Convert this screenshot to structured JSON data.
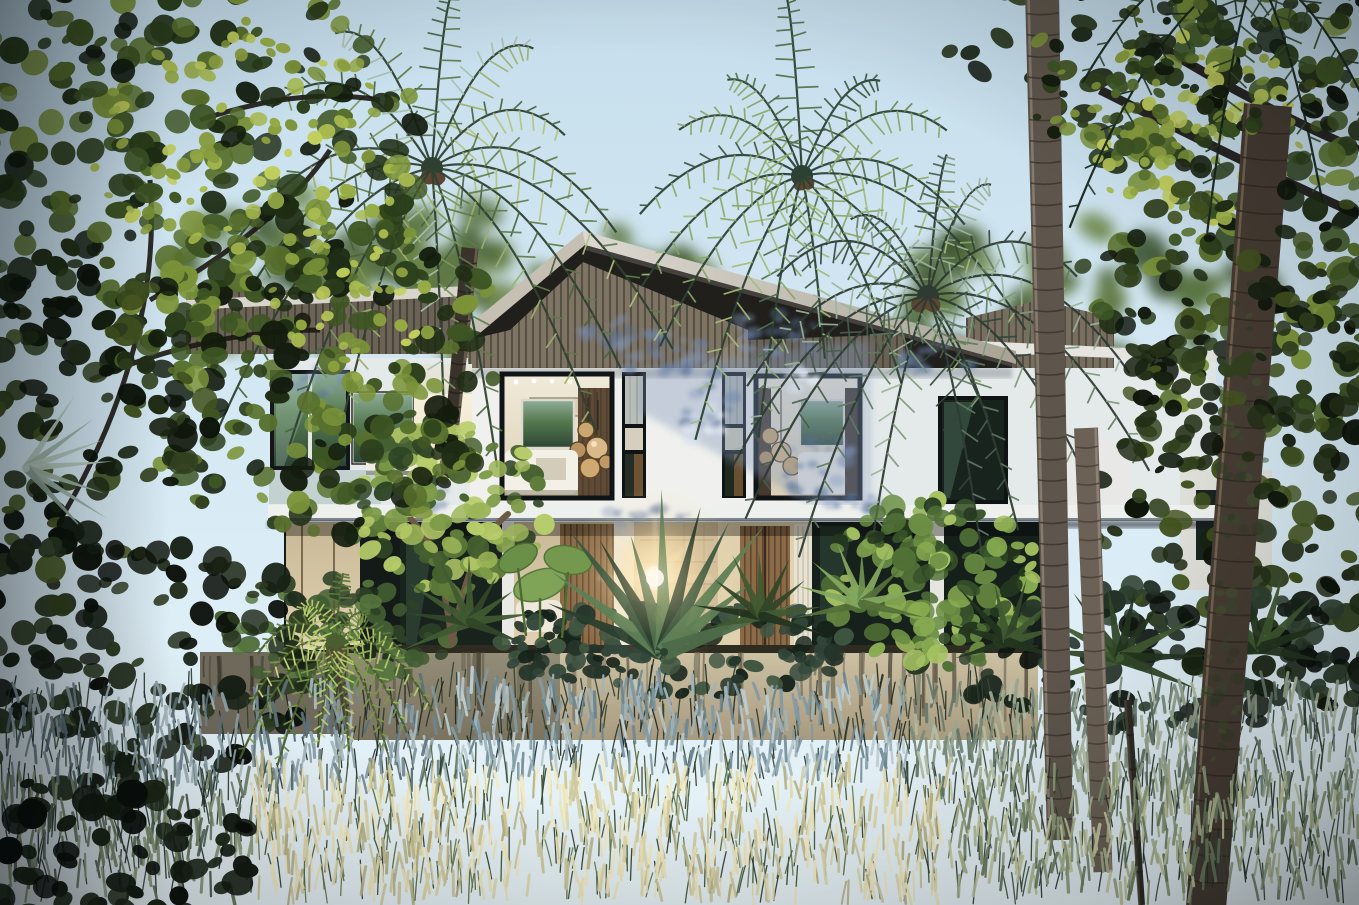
{
  "scene": {
    "description": "Dusk photorealistic rendering of a modern two-storey tropical villa with a wood-slat gable roof, glowing bedroom windows and open ground-floor bays, hidden behind palm trees, jungle foliage, palm trunks and a meadow of backlit feather grass",
    "colors": {
      "sky_top": "#c6deec",
      "sky_mid": "#d8ebf5",
      "sky_low": "#e9f4f8",
      "wall": "#f0f1ee",
      "wall_cool": "#e4e9ea",
      "roof_dark": "#201f1b",
      "slat_lit": "#8f8472",
      "slat_line": "#635b4d",
      "slat_mid": "#776e5f",
      "slat_dark": "#6b6355",
      "fascia": "#c9c3b7",
      "fascia_bright": "#dcd9d1",
      "frame": "#14171a",
      "glass_dark": "#18231e",
      "glass_green": "#3a5242",
      "interior_warm": "#e4d7ba",
      "interior_wood": "#8a6a47",
      "wood_dark": "#46382c",
      "concrete": "#cfc3a6",
      "concrete_shadow": "#9a8f76",
      "slab": "#eef0ee",
      "stone_wall": "#cbb896",
      "curtain": "#e8e2d2",
      "flare_core": "#fff8e4",
      "flare_glow": "#ffe3a6",
      "bed_white": "#f3f0e8",
      "pendant_brass": "#c9a76f"
    },
    "palettes": {
      "bgGreen": [
        "#3c5330",
        "#4c6438",
        "#5d7642",
        "#6d854b"
      ],
      "treeDark": [
        "#131c0e",
        "#1f2d15",
        "#2b3e1b",
        "#3e5523",
        "#58702d",
        "#7b9339"
      ],
      "treeDeep": [
        "#0e150b",
        "#182212",
        "#232f17",
        "#31411e",
        "#42531f"
      ],
      "treeLit": [
        "#8ba03f",
        "#a9bc50",
        "#c2cf5e",
        "#97ab46"
      ],
      "frangipani": [
        "#2e4424",
        "#46602f",
        "#5f7c3a",
        "#7d9a48",
        "#9cb558",
        "#b7cc6a"
      ],
      "bushLit": [
        "#24371f",
        "#38522a",
        "#507036",
        "#6c8f44",
        "#8aad52",
        "#a6c263"
      ],
      "planterDark": [
        "#16231a",
        "#24352a",
        "#32473a",
        "#405641"
      ],
      "planterMid": [
        "#1d2c1c",
        "#2e4227",
        "#415c32",
        "#57763e"
      ],
      "shrubDark": [
        "#0c110c",
        "#161f13",
        "#202b19",
        "#2c3a21"
      ],
      "shrubDeep": [
        "#090e0a",
        "#121a10",
        "#1b2516"
      ],
      "groundCover": [
        "#0d130e",
        "#18231a",
        "#243227",
        "#2f4030"
      ],
      "palmA": [
        "#49633f",
        "#5f7b4a",
        "#7b955c",
        "#9db06e",
        "#b4c27e",
        "#a8bfae"
      ],
      "palmB": [
        "#3d5540",
        "#527049",
        "#6b8a55",
        "#8aa768",
        "#a3bb7a"
      ],
      "palmC": [
        "#36463c",
        "#495d4e",
        "#617a62",
        "#7e9a7c",
        "#9db39a"
      ],
      "palmDark": [
        "#1c2b1e",
        "#283c2a",
        "#354c34",
        "#44603f"
      ],
      "litPalm": [
        "#7d9a4a",
        "#9cb85c",
        "#bccf70",
        "#d6e088",
        "#5d7a3c"
      ],
      "travPalm": [
        "#2b3f2e",
        "#3d5840",
        "#4e6c4a",
        "#5f7f55"
      ],
      "fanDark": [
        "#23351f",
        "#314728",
        "#405a31"
      ],
      "fanLit": [
        "#55703a",
        "#6d8f4f",
        "#84a85e"
      ],
      "silver": [
        "#9fb5a8",
        "#b5c8bc",
        "#8aa095"
      ],
      "moss": [
        "#2f3a26",
        "#3a4a2e",
        "#44552f"
      ],
      "shadowBlue": [
        "rgba(110,134,173,0.5)",
        "rgba(88,112,152,0.45)",
        "rgba(130,152,190,0.4)"
      ],
      "lightDapple": [
        "rgba(235,241,250,0.55)",
        "rgba(214,226,242,0.5)"
      ],
      "tipsShadowL": [
        "#5c7078",
        "#72868f",
        "#8da0a8",
        "#a6b8bc"
      ],
      "tipsShadow": [
        "#8199a2",
        "#9fb3b9",
        "#bccbcd",
        "#6b8590"
      ],
      "tipsSage": [
        "#7c8b7a",
        "#98a691",
        "#b2bda4",
        "#65776a"
      ],
      "tipsDim": [
        "#4e5f52",
        "#66755f",
        "#808e70",
        "#939f7e"
      ],
      "tipsWarm": [
        "#cfc9a0",
        "#e0d9ac",
        "#eee6bc",
        "#b9b488",
        "#f4ecc8"
      ],
      "tipsMixed": [
        "#8e9c7c",
        "#aab58e",
        "#c5c9a0",
        "#6b7c60"
      ],
      "stemsDark": [
        "#1a2620",
        "#27352c",
        "#31402f"
      ],
      "stemsDark2": [
        "#232f27",
        "#31402f",
        "#3c4c38"
      ],
      "stemsWarm": [
        "#3c4e2e",
        "#55683a",
        "#2c3a24",
        "#68794a"
      ]
    },
    "clusters": [
      {
        "t": "bg-trees",
        "cx": 520,
        "cy": 295,
        "rx": 210,
        "ry": 95,
        "n": 45,
        "r0": 10,
        "r1": 26,
        "pal": "bgGreen"
      },
      {
        "t": "bg-trees",
        "cx": 1075,
        "cy": 300,
        "rx": 190,
        "ry": 85,
        "n": 40,
        "r0": 10,
        "r1": 24,
        "pal": "bgGreen"
      },
      {
        "t": "bg-trees",
        "cx": 300,
        "cy": 270,
        "rx": 170,
        "ry": 75,
        "n": 30,
        "r0": 10,
        "r1": 22,
        "pal": "bgGreen"
      },
      {
        "t": "planter-bushes",
        "cx": 933,
        "cy": 583,
        "rx": 108,
        "ry": 86,
        "n": 140,
        "r0": 5,
        "r1": 13,
        "pal": "bushLit"
      },
      {
        "t": "planter-bushes",
        "cx": 700,
        "cy": 648,
        "rx": 150,
        "ry": 48,
        "n": 90,
        "r0": 5,
        "r1": 12,
        "pal": "planterDark"
      },
      {
        "t": "planter-bushes",
        "cx": 330,
        "cy": 636,
        "rx": 118,
        "ry": 58,
        "n": 80,
        "r0": 5,
        "r1": 12,
        "pal": "planterMid"
      },
      {
        "t": "planter-bushes",
        "cx": 560,
        "cy": 640,
        "rx": 60,
        "ry": 40,
        "n": 40,
        "r0": 4,
        "r1": 10,
        "pal": "planterDark"
      },
      {
        "t": "frangipani",
        "cx": 445,
        "cy": 508,
        "rx": 102,
        "ry": 86,
        "n": 130,
        "r0": 5,
        "r1": 13,
        "pal": "frangipani"
      },
      {
        "t": "left-tree",
        "cx": 150,
        "cy": 150,
        "rx": 270,
        "ry": 225,
        "n": 300,
        "r0": 6,
        "r1": 16,
        "pal": "treeDark"
      },
      {
        "t": "left-tree",
        "cx": 320,
        "cy": 368,
        "rx": 195,
        "ry": 170,
        "n": 210,
        "r0": 6,
        "r1": 15,
        "pal": "treeDark"
      },
      {
        "t": "left-tree",
        "cx": 55,
        "cy": 430,
        "rx": 165,
        "ry": 185,
        "n": 140,
        "r0": 6,
        "r1": 16,
        "pal": "treeDeep"
      },
      {
        "t": "left-tree",
        "cx": 255,
        "cy": 140,
        "rx": 165,
        "ry": 120,
        "n": 80,
        "r0": 4,
        "r1": 9,
        "pal": "treeLit"
      },
      {
        "t": "left-tree",
        "cx": 360,
        "cy": 300,
        "rx": 90,
        "ry": 80,
        "n": 40,
        "r0": 4,
        "r1": 8,
        "pal": "treeLit"
      },
      {
        "t": "right-canopy",
        "cx": 1205,
        "cy": 38,
        "rx": 265,
        "ry": 115,
        "n": 110,
        "r0": 6,
        "r1": 15,
        "pal": "treeDeep"
      },
      {
        "t": "right-canopy",
        "cx": 1300,
        "cy": 205,
        "rx": 225,
        "ry": 240,
        "n": 240,
        "r0": 6,
        "r1": 16,
        "pal": "treeDark"
      },
      {
        "t": "right-canopy",
        "cx": 1190,
        "cy": 130,
        "rx": 120,
        "ry": 100,
        "n": 70,
        "r0": 4,
        "r1": 9,
        "pal": "treeLit"
      },
      {
        "t": "right-canopy",
        "cx": 1295,
        "cy": 500,
        "rx": 205,
        "ry": 215,
        "n": 200,
        "r0": 6,
        "r1": 16,
        "pal": "treeDeep"
      },
      {
        "t": "right-ground",
        "cx": 1180,
        "cy": 660,
        "rx": 235,
        "ry": 75,
        "n": 110,
        "r0": 6,
        "r1": 14,
        "pal": "groundCover"
      },
      {
        "t": "left-shrubs",
        "cx": 110,
        "cy": 660,
        "rx": 230,
        "ry": 135,
        "n": 150,
        "r0": 6,
        "r1": 15,
        "pal": "shrubDark"
      },
      {
        "t": "right-front-leaves",
        "cx": 1248,
        "cy": 330,
        "rx": 155,
        "ry": 175,
        "n": 90,
        "r0": 5,
        "r1": 13,
        "pal": "treeDeep"
      },
      {
        "t": "right-front-leaves",
        "cx": 1152,
        "cy": 82,
        "rx": 135,
        "ry": 85,
        "n": 55,
        "r0": 4,
        "r1": 10,
        "pal": "treeDark"
      },
      {
        "t": "trunk-moss",
        "cx": 1242,
        "cy": 420,
        "rx": 24,
        "ry": 150,
        "n": 36,
        "r0": 3,
        "r1": 7,
        "pal": "moss",
        "op": 0.55
      },
      {
        "t": "trunk-moss",
        "cx": 1222,
        "cy": 680,
        "rx": 20,
        "ry": 110,
        "n": 26,
        "r0": 3,
        "r1": 7,
        "pal": "moss",
        "op": 0.5
      },
      {
        "t": "bottom-left-bush",
        "cx": 100,
        "cy": 852,
        "rx": 155,
        "ry": 78,
        "n": 70,
        "r0": 7,
        "r1": 16,
        "pal": "shrubDeep"
      }
    ],
    "dapples": [
      {
        "cx": 662,
        "cy": 352,
        "rx": 44,
        "ry": 26,
        "n": 26,
        "pal": "shadowBlue"
      },
      {
        "cx": 702,
        "cy": 392,
        "rx": 32,
        "ry": 42,
        "n": 22,
        "pal": "shadowBlue"
      },
      {
        "cx": 772,
        "cy": 334,
        "rx": 48,
        "ry": 22,
        "n": 24,
        "pal": "shadowBlue"
      },
      {
        "cx": 822,
        "cy": 468,
        "rx": 42,
        "ry": 30,
        "n": 20,
        "pal": "shadowBlue"
      },
      {
        "cx": 856,
        "cy": 504,
        "rx": 30,
        "ry": 12,
        "n": 12,
        "pal": "shadowBlue"
      },
      {
        "cx": 646,
        "cy": 518,
        "rx": 48,
        "ry": 10,
        "n": 14,
        "pal": "shadowBlue"
      },
      {
        "cx": 306,
        "cy": 382,
        "rx": 42,
        "ry": 18,
        "n": 16,
        "pal": "shadowBlue"
      },
      {
        "cx": 424,
        "cy": 498,
        "rx": 30,
        "ry": 10,
        "n": 10,
        "pal": "shadowBlue"
      },
      {
        "cx": 940,
        "cy": 360,
        "rx": 40,
        "ry": 16,
        "n": 14,
        "pal": "shadowBlue"
      },
      {
        "cx": 610,
        "cy": 332,
        "rx": 30,
        "ry": 14,
        "n": 12,
        "pal": "shadowBlue"
      },
      {
        "cx": 706,
        "cy": 424,
        "rx": 26,
        "ry": 20,
        "n": 12,
        "pal": "lightDapple"
      },
      {
        "cx": 802,
        "cy": 382,
        "rx": 22,
        "ry": 16,
        "n": 10,
        "pal": "lightDapple"
      }
    ],
    "crowns": [
      {
        "t": "palm-crowns",
        "cx": 432,
        "cy": 168,
        "n": 16,
        "len0": 170,
        "len1": 252,
        "droop": 0.7,
        "pal": "palmA",
        "rib": "#2f4030"
      },
      {
        "t": "palm-crowns",
        "cx": 802,
        "cy": 176,
        "n": 15,
        "len0": 150,
        "len1": 232,
        "droop": 0.6,
        "pal": "palmB",
        "rib": "#2c4134"
      },
      {
        "t": "palm-crowns",
        "cx": 928,
        "cy": 296,
        "n": 15,
        "len0": 150,
        "len1": 225,
        "droop": 0.72,
        "pal": "palmC",
        "rib": "#2e3b33"
      },
      {
        "t": "right-canopy",
        "cx": 1255,
        "cy": -30,
        "n": 9,
        "len0": 170,
        "len1": 230,
        "droop": 0.8,
        "pal": "palmDark",
        "rib": "#16241a"
      },
      {
        "t": "small-palm",
        "cx": 336,
        "cy": 644,
        "n": 13,
        "len0": 68,
        "len1": 104,
        "droop": 0.85,
        "pal": "litPalm",
        "rib": "#4a5e30"
      }
    ],
    "fans": [
      {
        "t": "planter-plants-front",
        "cx": 664,
        "cy": 652,
        "n": 11,
        "a0": -158,
        "a1": -22,
        "len0": 112,
        "len1": 168,
        "wb": 9,
        "pal": "travPalm"
      },
      {
        "t": "planter-plants-front",
        "cx": 470,
        "cy": 622,
        "n": 9,
        "a0": -200,
        "a1": 20,
        "len0": 52,
        "len1": 74,
        "wb": 5,
        "pal": "fanDark"
      },
      {
        "t": "planter-plants-front",
        "cx": 762,
        "cy": 616,
        "n": 9,
        "a0": -195,
        "a1": 15,
        "len0": 55,
        "len1": 78,
        "wb": 5,
        "pal": "fanDark"
      },
      {
        "t": "planter-plants-front",
        "cx": 862,
        "cy": 604,
        "n": 9,
        "a0": -190,
        "a1": 10,
        "len0": 50,
        "len1": 70,
        "wb": 5,
        "pal": "fanLit"
      },
      {
        "t": "right-ground",
        "cx": 1120,
        "cy": 658,
        "n": 10,
        "a0": -200,
        "a1": 20,
        "len0": 70,
        "len1": 92,
        "wb": 6,
        "pal": "fanDark"
      },
      {
        "t": "right-ground",
        "cx": 1008,
        "cy": 642,
        "n": 8,
        "a0": -195,
        "a1": 15,
        "len0": 55,
        "len1": 75,
        "wb": 5,
        "pal": "fanDark"
      },
      {
        "t": "right-ground",
        "cx": 1262,
        "cy": 648,
        "n": 8,
        "a0": -190,
        "a1": 10,
        "len0": 60,
        "len1": 80,
        "wb": 6,
        "pal": "fanDark"
      },
      {
        "t": "left-tree",
        "cx": 26,
        "cy": 468,
        "n": 7,
        "a0": -55,
        "a1": 50,
        "len0": 78,
        "len1": 100,
        "wb": 4,
        "pal": "silver"
      }
    ],
    "trunks": [
      {
        "t": "palm-trunk-a",
        "x0": 470,
        "y0": 248,
        "x1": 447,
        "y1": 478,
        "w0": 17,
        "w1": 13,
        "fill": "#3a332b",
        "ring": "#241f1a",
        "gap": 14,
        "lit": "#6e6152",
        "side": -1
      },
      {
        "t": "right-trunks",
        "x0": 1042,
        "y0": -8,
        "x1": 1060,
        "y1": 840,
        "w0": 34,
        "w1": 26,
        "fill": "#5e564c",
        "ring": "#38322b",
        "gap": 21,
        "lit": "#8d8174",
        "side": 1
      },
      {
        "t": "right-trunks",
        "x0": 1086,
        "y0": 428,
        "x1": 1103,
        "y1": 872,
        "w0": 24,
        "w1": 19,
        "fill": "#6b6156",
        "ring": "#433c33",
        "gap": 18,
        "lit": "#93867a",
        "side": -1
      },
      {
        "t": "right-trunks",
        "x0": 1268,
        "y0": 105,
        "x1": 1206,
        "y1": 908,
        "w0": 48,
        "w1": 40,
        "fill": "#463c33",
        "ring": "#2e2822",
        "gap": 26,
        "lit": "#7c6a55",
        "side": 1
      },
      {
        "t": "right-trunks",
        "x0": 1128,
        "y0": 700,
        "x1": 1142,
        "y1": 905,
        "w0": 7,
        "w1": 6,
        "fill": "#2e2a24",
        "ring": "#201c18",
        "gap": 30,
        "lit": "#4a433a",
        "side": 1
      },
      {
        "t": "small-palm",
        "x0": 336,
        "y0": 650,
        "x1": 347,
        "y1": 716,
        "w0": 9,
        "w1": 7,
        "fill": "#4a4034",
        "ring": "#332c24",
        "gap": 10,
        "lit": "#6e6250",
        "side": -1
      }
    ],
    "grass": [
      {
        "t": "grass-back",
        "x0": 0,
        "x1": 430,
        "y0": 696,
        "y1": 794,
        "nS": 130,
        "nT": 240,
        "len0": 14,
        "len1": 24,
        "tips": "tipsShadowL",
        "stems": "stemsDark"
      },
      {
        "t": "grass-back",
        "x0": 430,
        "x1": 905,
        "y0": 692,
        "y1": 782,
        "nS": 150,
        "nT": 300,
        "len0": 14,
        "len1": 26,
        "tips": "tipsShadow",
        "stems": "stemsDark"
      },
      {
        "t": "grass-back",
        "x0": 905,
        "x1": 1359,
        "y0": 696,
        "y1": 800,
        "nS": 150,
        "nT": 300,
        "len0": 14,
        "len1": 26,
        "tips": "tipsSage",
        "stems": "stemsDark2"
      },
      {
        "t": "grass-front",
        "x0": 0,
        "x1": 255,
        "y0": 788,
        "y1": 905,
        "nS": 90,
        "nT": 150,
        "len0": 16,
        "len1": 28,
        "tips": "tipsDim",
        "stems": "stemsDark"
      },
      {
        "t": "grass-front",
        "x0": 255,
        "x1": 950,
        "y0": 780,
        "y1": 905,
        "nS": 260,
        "nT": 540,
        "len0": 16,
        "len1": 30,
        "tips": "tipsWarm",
        "stems": "stemsWarm"
      },
      {
        "t": "grass-front",
        "x0": 950,
        "x1": 1359,
        "y0": 788,
        "y1": 905,
        "nS": 160,
        "nT": 300,
        "len0": 16,
        "len1": 28,
        "tips": "tipsMixed",
        "stems": "stemsDark2"
      }
    ],
    "streaks": [
      {
        "t": "planter-streaks",
        "x0": 352,
        "x1": 1032,
        "y": 652,
        "n": 48,
        "len0": 18,
        "len1": 72,
        "colors": [
          "#57503f",
          "#3f3a2d",
          "#6b6450"
        ]
      },
      {
        "t": "planter-streaks",
        "x0": 204,
        "x1": 346,
        "y": 656,
        "n": 14,
        "len0": 16,
        "len1": 50,
        "colors": [
          "#433e31",
          "#2f2b21"
        ]
      }
    ]
  }
}
